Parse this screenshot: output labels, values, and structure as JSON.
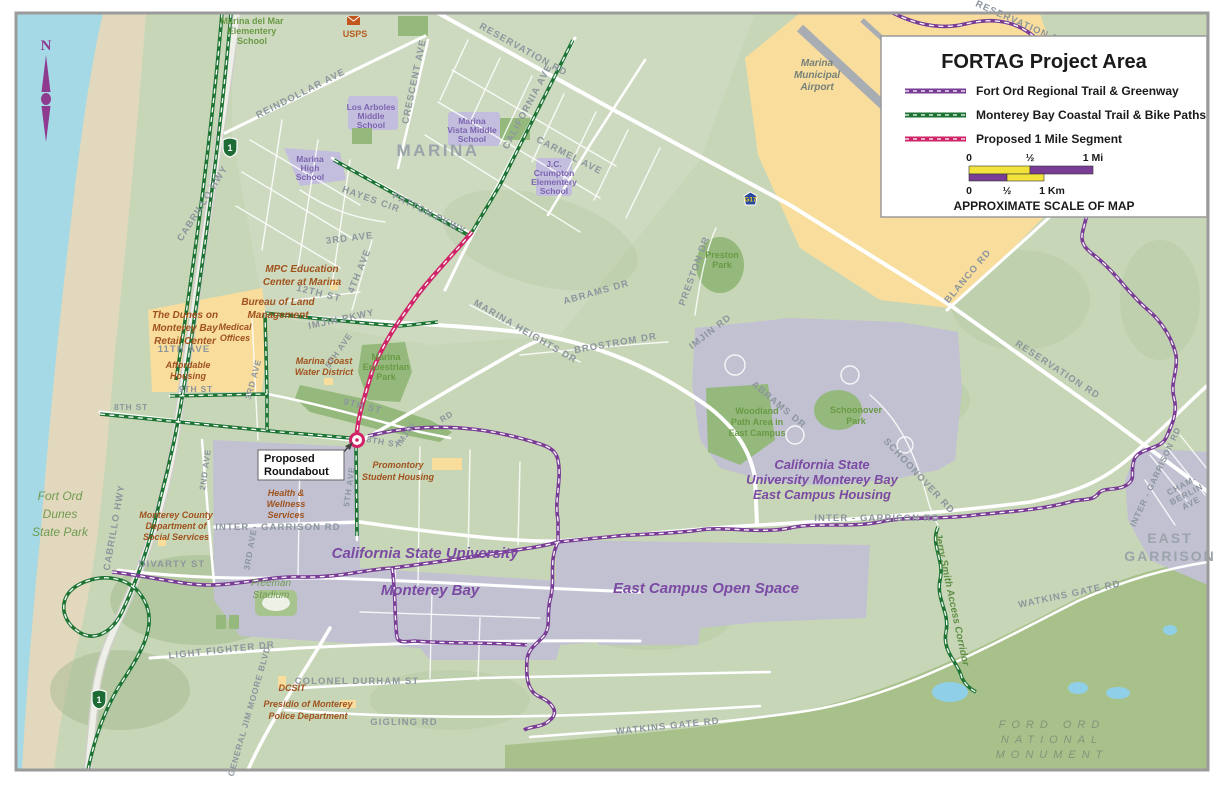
{
  "legend": {
    "title": "FORTAG Project Area",
    "items": [
      {
        "label": "Fort Ord Regional Trail & Greenway",
        "color": "#7a3d96"
      },
      {
        "label": "Monterey Bay Coastal Trail & Bike Paths",
        "color": "#1e7434"
      },
      {
        "label": "Proposed 1 Mile Segment",
        "color": "#cf2568"
      }
    ],
    "scale": {
      "mi_ticks": [
        "0",
        "½",
        "1 Mi"
      ],
      "km_ticks": [
        "0",
        "½",
        "1 Km"
      ],
      "caption": "APPROXIMATE SCALE OF MAP"
    }
  },
  "colors": {
    "fortag_purple": "#7a3d96",
    "coastal_green": "#1e7434",
    "proposed_pink": "#cf2568",
    "scale_yellow": "#f2e23c"
  },
  "compass": {
    "north": "N"
  },
  "shields": {
    "highway1": "1",
    "county_g17": "G17"
  },
  "callout": {
    "roundabout": [
      "Proposed",
      "Roundabout"
    ]
  },
  "labels": {
    "marina_city": "MARINA",
    "east_garrison": [
      "EAST",
      "GARRISON"
    ],
    "usps": "USPS",
    "marina_del_mar": [
      "Marina del Mar",
      "Elementery",
      "School"
    ],
    "los_arboles": [
      "Los Arboles",
      "Middle",
      "School"
    ],
    "marina_vista": [
      "Marina",
      "Vista Middle",
      "School"
    ],
    "jc_crumpton": [
      "J.C.",
      "Crumpton",
      "Elementery",
      "School"
    ],
    "marina_high": [
      "Marina",
      "High",
      "School"
    ],
    "airport": [
      "Marina",
      "Municipal",
      "Airport"
    ],
    "reservation_rd_top": "RESERVATION RD",
    "reservation_rd_ne": "RESERVATION RD",
    "reservation_rd_mid": "RESERVATION RD",
    "reindollar_ave": "REINDOLLAR AVE",
    "crescent_ave": "CRESCENT AVE",
    "california_ave": "CALIFORNIA AVE",
    "carmel_ave": "CARMEL AVE",
    "hayes_cir": "HAYES CIR",
    "patton_pkwy": "PATTON PKWY",
    "third_ave_top": "3RD AVE",
    "fourth_ave": "4TH AVE",
    "twelfth_st": "12TH ST",
    "imjin_pkwy": "IMJIN PKWY",
    "mpc": [
      "MPC Education",
      "Center at Marina"
    ],
    "blm": [
      "Bureau of Land",
      "Management"
    ],
    "dunes_retail": [
      "The Dunes on",
      "Monterey Bay",
      "Retail Center"
    ],
    "eleventh_ave": "11TH AVE",
    "medical": [
      "Medical",
      "Offices"
    ],
    "affordable": [
      "Affordable",
      "Housing"
    ],
    "ninth_st_w": "9TH ST",
    "eighth_st_w": "8TH ST",
    "third_ave_mid": "3RD AVE",
    "water_district": [
      "Marina Coast",
      "Water District"
    ],
    "fifth_ave_n": "5TH AVE",
    "equestrian": [
      "Marina",
      "Equestrian",
      "Park"
    ],
    "ninth_st_e": "9TH ST",
    "eighth_st_c": "8TH ST",
    "imjin_word": "IMJIN",
    "rd_word": "RD",
    "imjin_rd": "IMJIN RD",
    "marina_heights_dr": "MARINA HEIGHTS DR",
    "abrams_dr_n": "ABRAMS DR",
    "brostrom_dr": "BROSTROM DR",
    "preston_dr": "PRESTON DR",
    "preston_park": [
      "Preston",
      "Park"
    ],
    "blanco_rd": "BLANCO RD",
    "cabrillo_hwy_n": "CABRILLO HWY",
    "cabrillo_hwy_s": "CABRILLO HWY",
    "fort_ord_dunes": [
      "Fort Ord",
      "Dunes",
      "State Park"
    ],
    "second_ave": "2ND AVE",
    "third_ave_s": "3RD AVE",
    "fifth_ave_s": "5TH AVE",
    "promontory": [
      "Promontory",
      "Student Housing"
    ],
    "health": [
      "Health &",
      "Wellness",
      "Services"
    ],
    "county_social": [
      "Monterey County",
      "Department of",
      "Social Services"
    ],
    "inter_garrison_w": "INTER - GARRISON RD",
    "inter_garrison_e": "INTER - GARRISON RD",
    "inter_garrison_eg": "INTER - GARRISON RD",
    "chamberlin": [
      "CHAM-",
      "BERLIN",
      "AVE"
    ],
    "divarty_st": "DIVARTY ST",
    "freeman": [
      "Freeman",
      "Stadium"
    ],
    "csumb": [
      "California State University",
      "Monterey Bay"
    ],
    "open_space": "East Campus Open Space",
    "woodland": [
      "Woodland",
      "Path Area in",
      "East Campus"
    ],
    "csumb_east": [
      "California State",
      "University Monterey Bay",
      "East Campus Housing"
    ],
    "abrams_dr_e": "ABRAMS DR",
    "schoonover_park": [
      "Schoonover",
      "Park"
    ],
    "schoonover_rd": "SCHOONOVER RD",
    "jerry_smith": "Jerry Smith Access Corridor",
    "watkins_gate_e": "WATKINS GATE RD",
    "watkins_gate_s": "WATKINS GATE RD",
    "light_fighter_dr": "LIGHT FIGHTER DR",
    "general_jim_moore": "GENERAL JIM MOORE BLVD",
    "colonel_durham": "COLONEL DURHAM ST",
    "dcsit": "DCSIT",
    "presidio_pd": [
      "Presidio of Monterey",
      "Police Department"
    ],
    "gigling_rd": "GIGLING RD",
    "ford_ord_monument": [
      "FORD ORD",
      "NATIONAL",
      "MONUMENT"
    ]
  }
}
